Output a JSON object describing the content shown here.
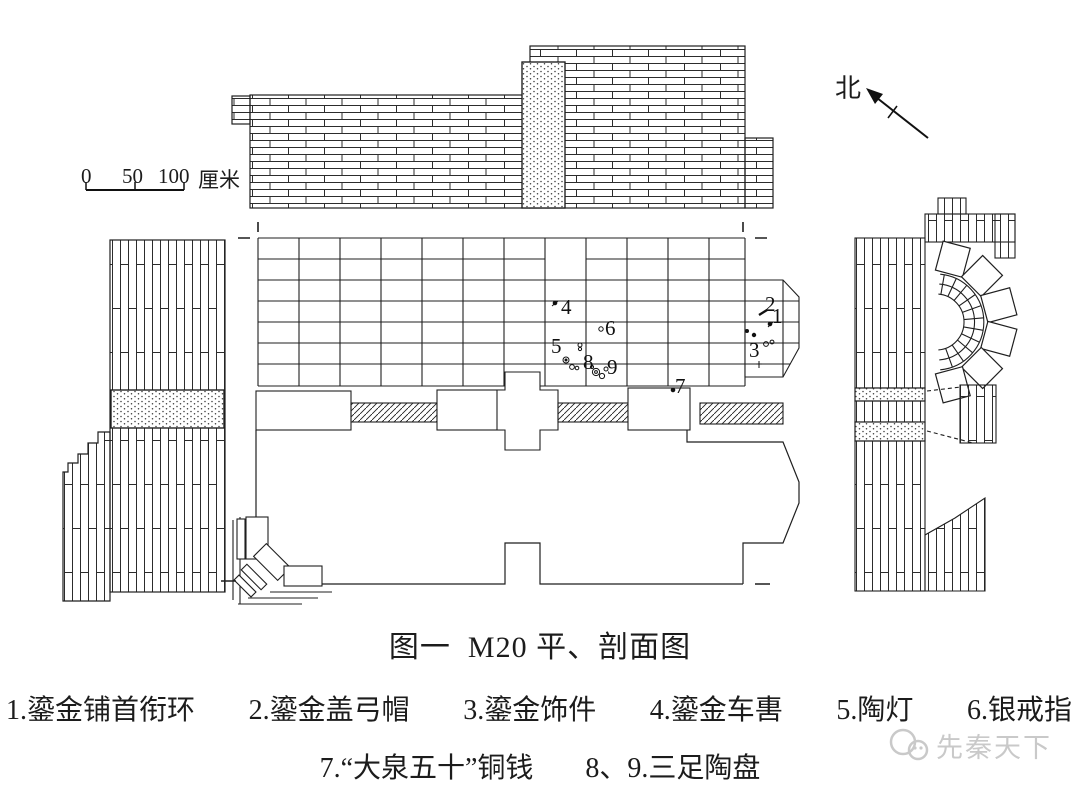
{
  "figure": {
    "title": "图一  M20 平、剖面图",
    "caption_row1": [
      "1.鎏金铺首衔环",
      "2.鎏金盖弓帽",
      "3.鎏金饰件",
      "4.鎏金车軎",
      "5.陶灯",
      "6.银戒指"
    ],
    "caption_row2": [
      "7.“大泉五十”铜钱",
      "8、9.三足陶盘"
    ],
    "watermark": "先秦天下"
  },
  "compass": {
    "label": "北"
  },
  "scale_bar": {
    "ticks": [
      "0",
      "50",
      "100"
    ],
    "unit": "厘米"
  },
  "plan": {
    "markers": [
      {
        "n": "1",
        "x": 772,
        "y": 306
      },
      {
        "n": "2",
        "x": 765,
        "y": 294
      },
      {
        "n": "3",
        "x": 749,
        "y": 340
      },
      {
        "n": "4",
        "x": 561,
        "y": 297
      },
      {
        "n": "5",
        "x": 551,
        "y": 336
      },
      {
        "n": "6",
        "x": 605,
        "y": 318
      },
      {
        "n": "7",
        "x": 675,
        "y": 376
      },
      {
        "n": "8",
        "x": 583,
        "y": 352
      },
      {
        "n": "9",
        "x": 607,
        "y": 357
      }
    ]
  }
}
